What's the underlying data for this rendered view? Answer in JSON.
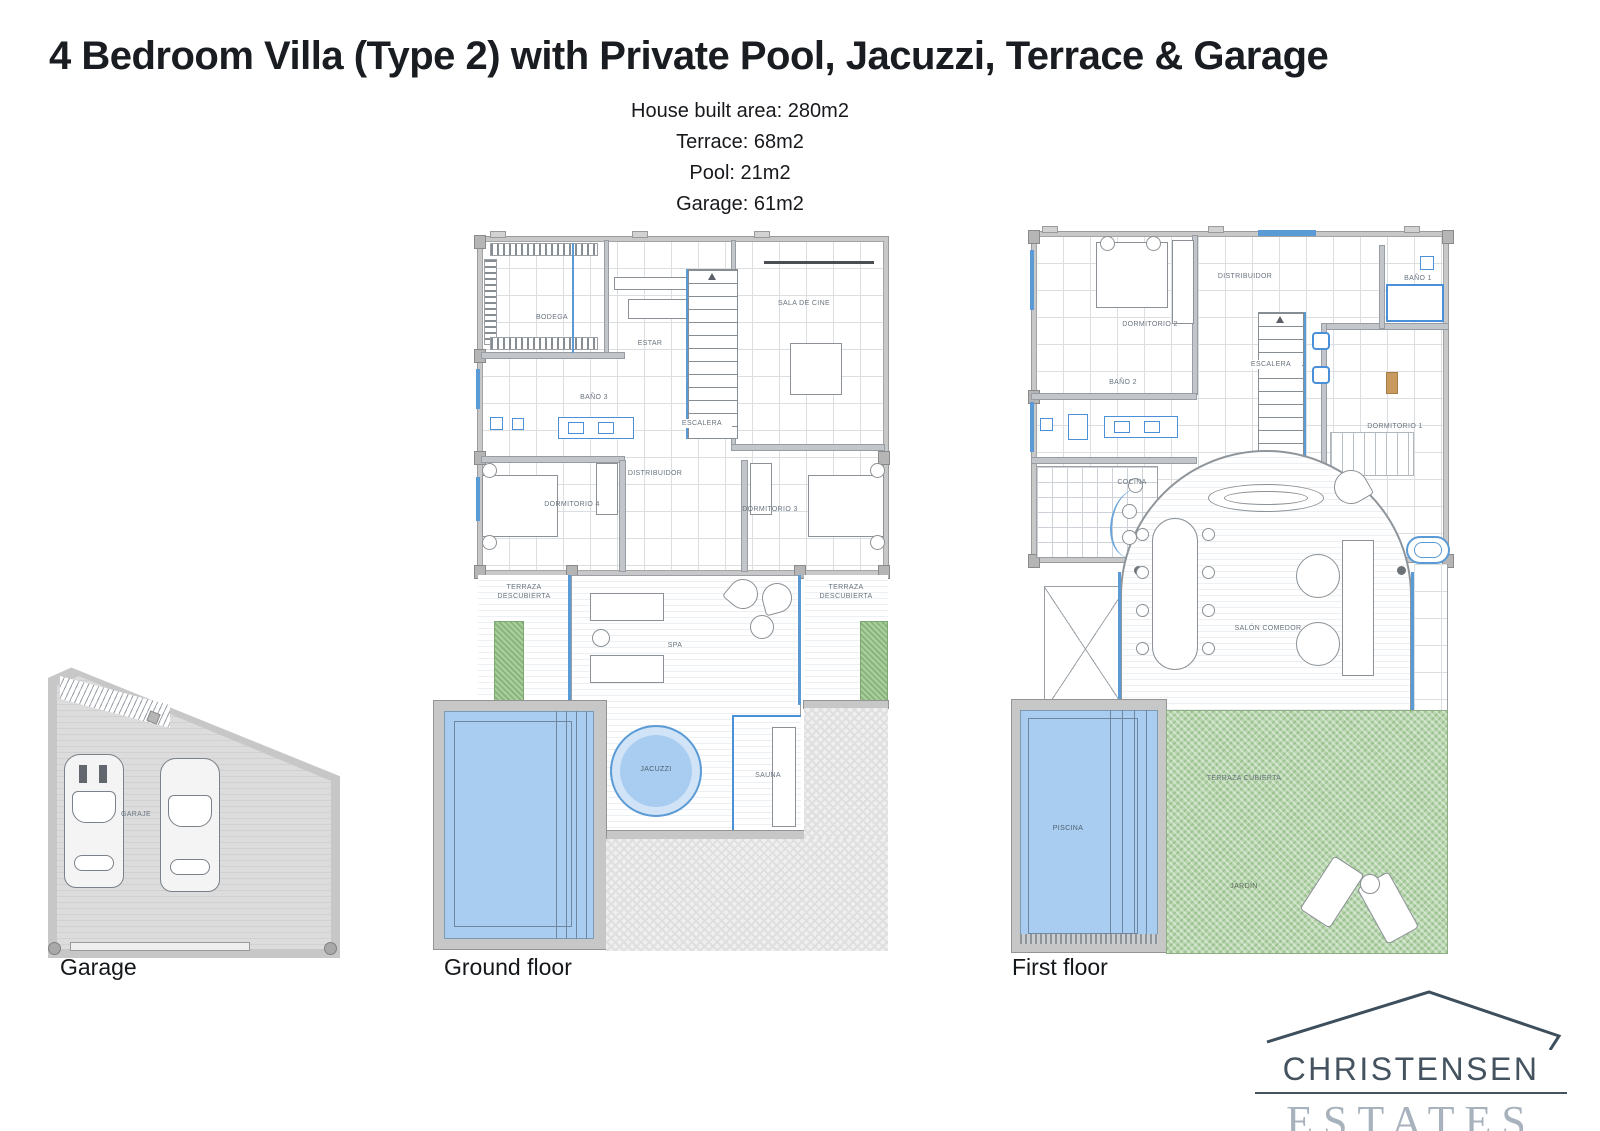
{
  "header": {
    "title": "4 Bedroom Villa (Type 2) with Private Pool, Jacuzzi, Terrace & Garage",
    "specs": [
      "House built area: 280m2",
      "Terrace: 68m2",
      "Pool: 21m2",
      "Garage: 61m2"
    ]
  },
  "captions": {
    "garage": "Garage",
    "ground": "Ground floor",
    "first": "First floor"
  },
  "ground": {
    "bodega": "BODEGA",
    "estar": "ESTAR",
    "sala_de_cine": "SALA DE CINE",
    "bano3": "BAÑO 3",
    "escalera": "ESCALERA",
    "distribuidor": "DISTRIBUIDOR",
    "dormitorio4": "DORMITORIO 4",
    "dormitorio3": "DORMITORIO 3",
    "terraza_left": "TERRAZA DESCUBIERTA",
    "terraza_right": "TERRAZA DESCUBIERTA",
    "spa": "SPA",
    "jacuzzi": "JACUZZI",
    "sauna": "SAUNA"
  },
  "first": {
    "distribuidor": "DISTRIBUIDOR",
    "dormitorio2": "DORMITORIO 2",
    "bano2": "BAÑO 2",
    "bano1": "BAÑO 1",
    "escalera": "ESCALERA",
    "dormitorio1": "DORMITORIO 1",
    "cocina": "COCINA",
    "salon_comedor": "SALÓN COMEDOR",
    "terraza_cubierta": "TERRAZA CUBIERTA",
    "piscina": "PISCINA",
    "jardin": "JARDÍN"
  },
  "garage": {
    "garaje": "GARAJE"
  },
  "logo": {
    "name": "CHRISTENSEN",
    "type": "ESTATES"
  },
  "colors": {
    "pool_blue": "#a9cdf0",
    "accent_blue": "#4a90d9",
    "garden_green": "#b8d6ae",
    "wall_gray": "#c8c8c8",
    "logo_dark": "#44535f",
    "logo_light": "#a8b2bc"
  }
}
